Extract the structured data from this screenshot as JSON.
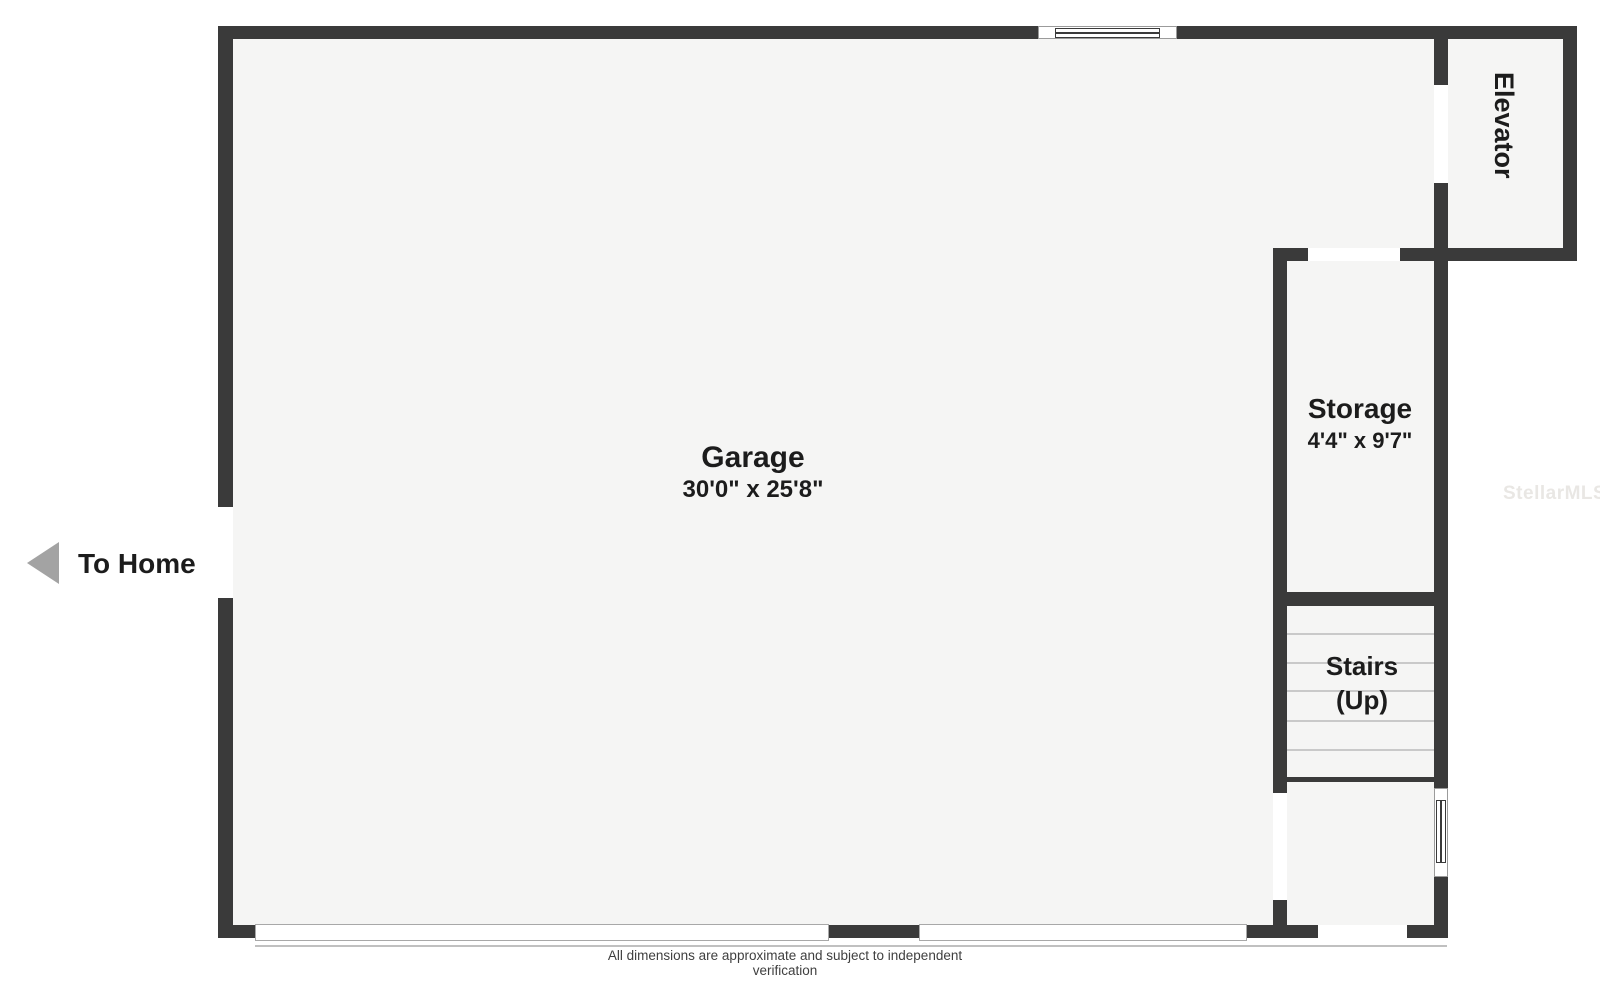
{
  "floorplan": {
    "rooms": {
      "garage": {
        "name": "Garage",
        "dimensions": "30'0\" x 25'8\""
      },
      "storage": {
        "name": "Storage",
        "dimensions": "4'4\" x 9'7\""
      },
      "stairs": {
        "name": "Stairs",
        "direction": "(Up)"
      },
      "elevator": {
        "name": "Elevator"
      }
    },
    "exit_label": "To Home",
    "watermark": "StellarMLS",
    "disclaimer": "All dimensions are approximate and subject to independent verification",
    "colors": {
      "wall": "#3a3a3a",
      "floor": "#f5f5f4",
      "background": "#ffffff",
      "accent_arrow": "#a3a3a3",
      "text": "#1c1c1c",
      "tread_line": "#c9c9c9",
      "watermark": "#e9e7e4",
      "disclaimer_text": "#3f3f3f"
    }
  }
}
